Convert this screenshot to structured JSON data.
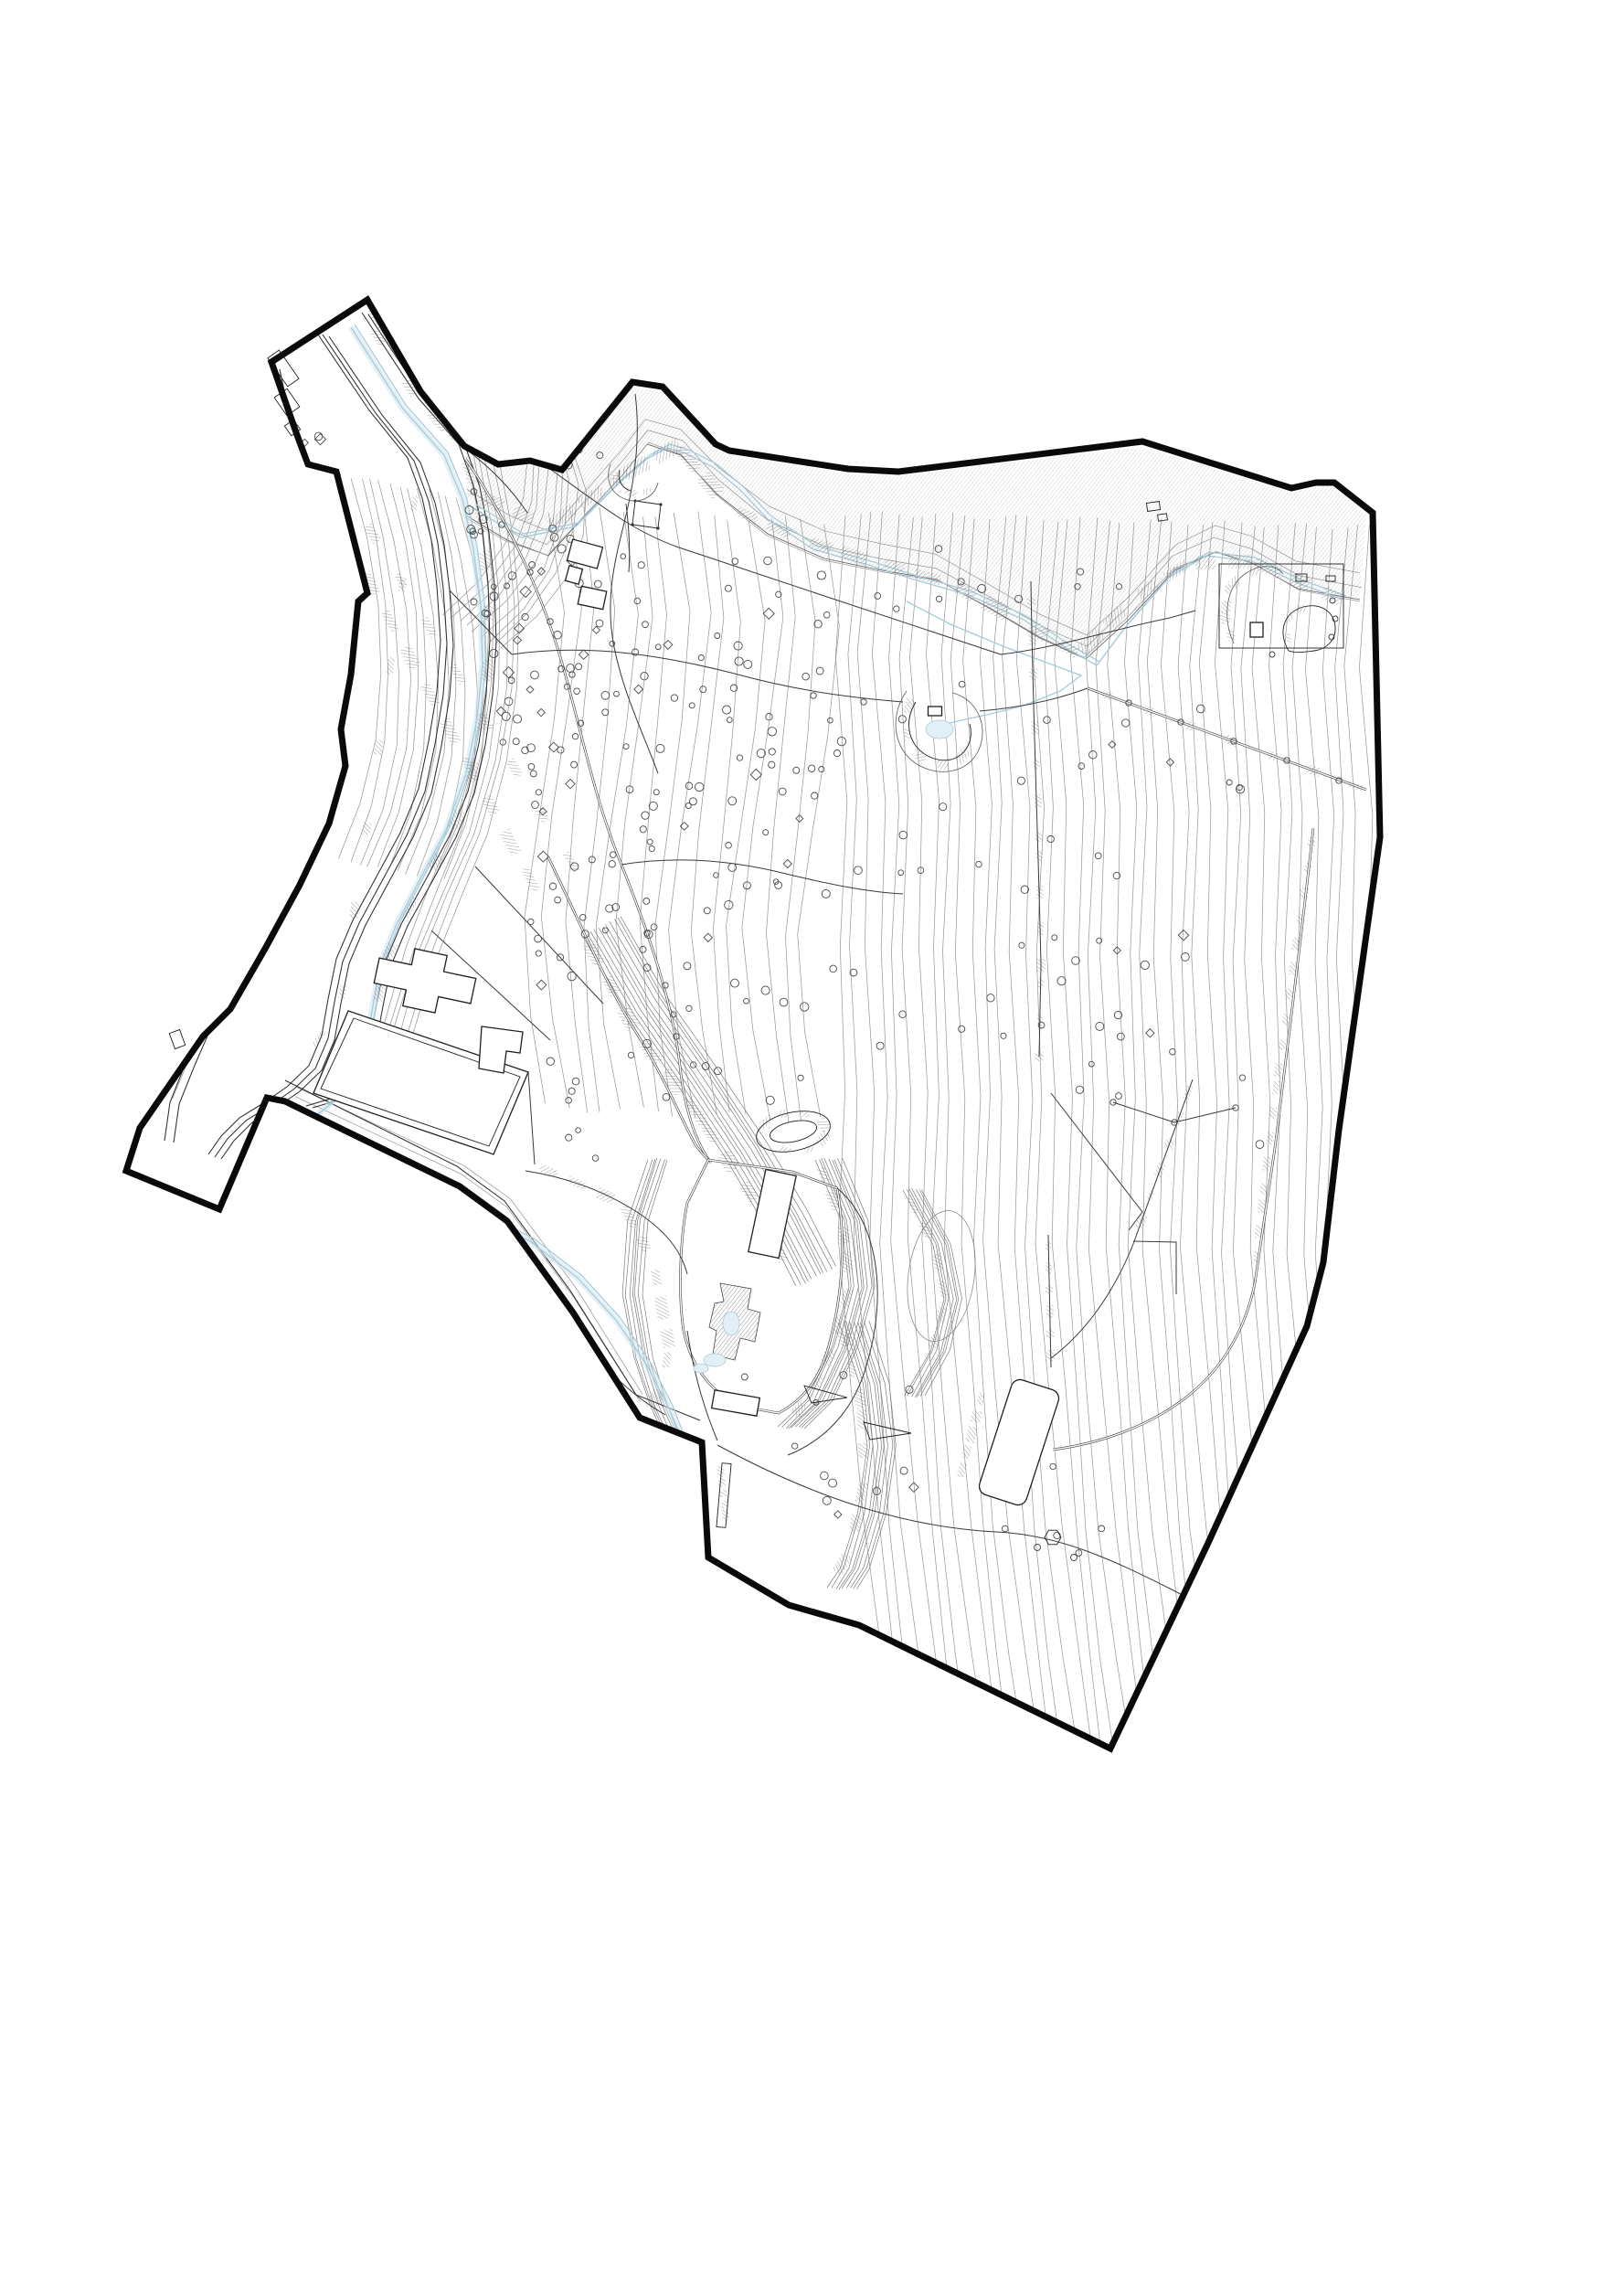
{
  "drawing": {
    "kind": "topographic-site-survey-plan",
    "visible_text": [],
    "palette": {
      "background": "#ffffff",
      "boundary": "#0a0a0a",
      "contour": "#9a9a9a",
      "bundle": "#7d7d7d",
      "path": "#3a3a3a",
      "road": "#2f2f2f",
      "water": "#a6cbda",
      "water_light": "#cde4ee",
      "water_fill": "#e2f0f6",
      "tree": "#4a4a4a",
      "building": "#1f1f1f",
      "hatch": "#6f6f6f"
    },
    "features": [
      "site-boundary",
      "road-corridor",
      "stream",
      "slope-hatch-bands",
      "contour-lines",
      "tree-symbols",
      "building-footprints",
      "footpaths",
      "earthwork-structures"
    ]
  }
}
